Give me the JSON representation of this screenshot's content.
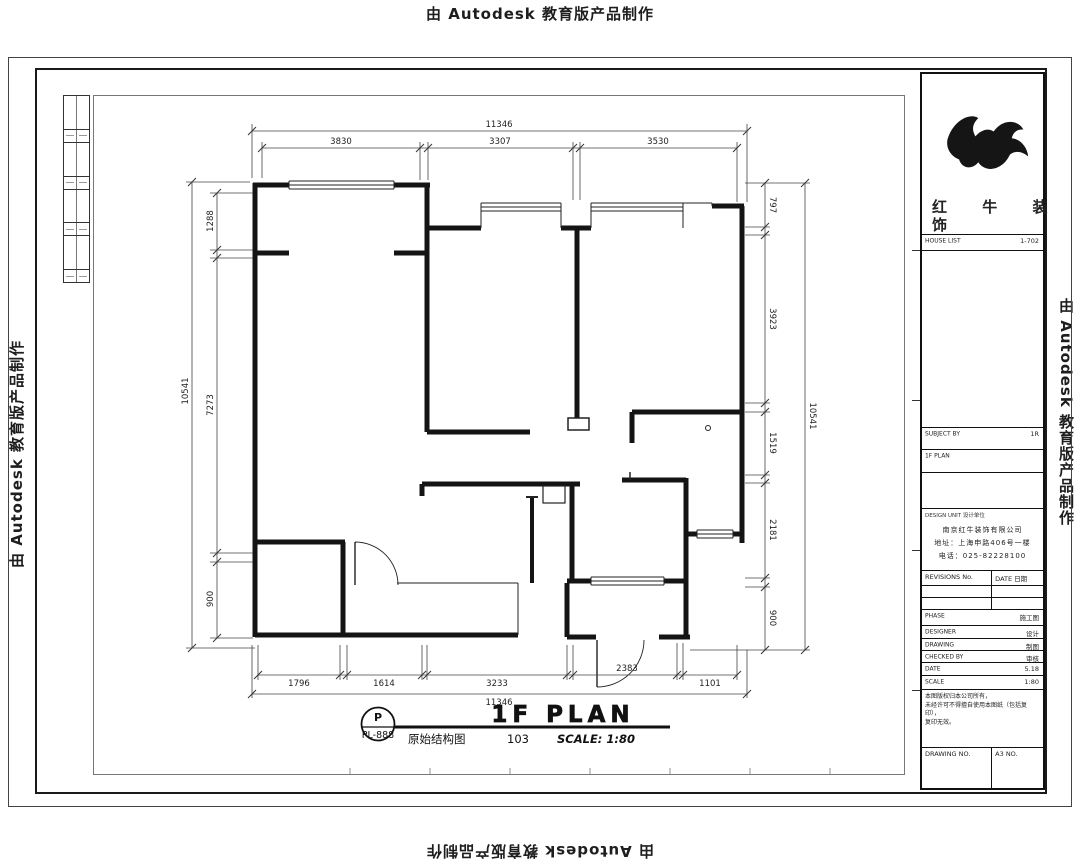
{
  "watermarks": {
    "top": "由 Autodesk 教育版产品制作",
    "bottom": "由 Autodesk 教育版产品制作",
    "left": "由 Autodesk 教育版产品制作",
    "right": "由 Autodesk 教育版产品制作"
  },
  "plan": {
    "title": "1F PLAN",
    "scale": "SCALE: 1:80",
    "stamp_top": "P",
    "stamp_bottom": "PL-888",
    "drawing_name": "原始结构图",
    "drawing_no": "103",
    "dims": {
      "top_total": "11346",
      "top": [
        "3830",
        "3307",
        "3530"
      ],
      "bottom": [
        "1796",
        "1614",
        "3233",
        "2383",
        "1101"
      ],
      "bottom_total": "11346",
      "left": [
        "1288",
        "7273",
        "900"
      ],
      "left_total": "10541",
      "right": [
        "797",
        "3923",
        "1519",
        "2181",
        "900"
      ],
      "right_total": "10541"
    }
  },
  "title_block": {
    "brand_line1": "红 牛 装",
    "brand_line2": "饰",
    "house_list_label": "HOUSE LIST",
    "house_list_value": "1-702",
    "subject_label": "SUBJECT BY",
    "subject_value": "1R",
    "plan_row": "1F PLAN",
    "unit_header": "DESIGN UNIT 设计单位",
    "company_name": "南京红牛装饰有限公司",
    "company_address": "地址：上海申路406号一楼",
    "company_phone": "电话：025-82228100",
    "rev_label": "REVISIONS No.",
    "rev_date_label": "DATE 日期",
    "phase_label": "PHASE",
    "phase_value": "施工图",
    "designer_label": "DESIGNER",
    "designer_value": "设计",
    "drawing_label": "DRAWING",
    "drawing_value": "制图",
    "checked_label": "CHECKED BY",
    "checked_value": "审核",
    "date_label": "DATE",
    "date_value": "5.18",
    "scale_label": "SCALE",
    "scale_value": "1:80",
    "note_line1": "本图版权归本公司所有，",
    "note_line2": "未经许可不得擅自使用本图纸（包括复印），",
    "note_line3": "复印无效。",
    "dwg_no_label": "DRAWING NO.",
    "sheet_label": "A3 NO."
  }
}
